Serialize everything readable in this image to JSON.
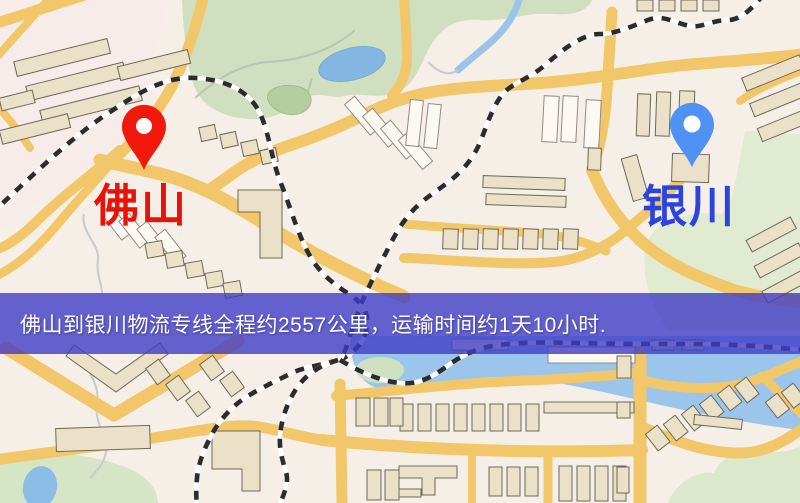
{
  "map": {
    "markers": {
      "origin": {
        "label": "佛山",
        "pin_color": "#f0190c",
        "label_color": "#e81208"
      },
      "destination": {
        "label": "银川",
        "pin_color": "#4e92f6",
        "label_color": "#2b44dd"
      }
    },
    "info_banner": {
      "text": "佛山到银川物流专线全程约2557公里，运输时间约1天10小时.",
      "background_color": "#403cc6",
      "text_color": "#ffffff"
    },
    "theme_colors": {
      "background": "#f6efe8",
      "road": "#f2c76a",
      "building": "#eae1c8",
      "park": "#cfdfc0",
      "water": "#9cc5ec",
      "railway": "#2c2c2e"
    }
  }
}
